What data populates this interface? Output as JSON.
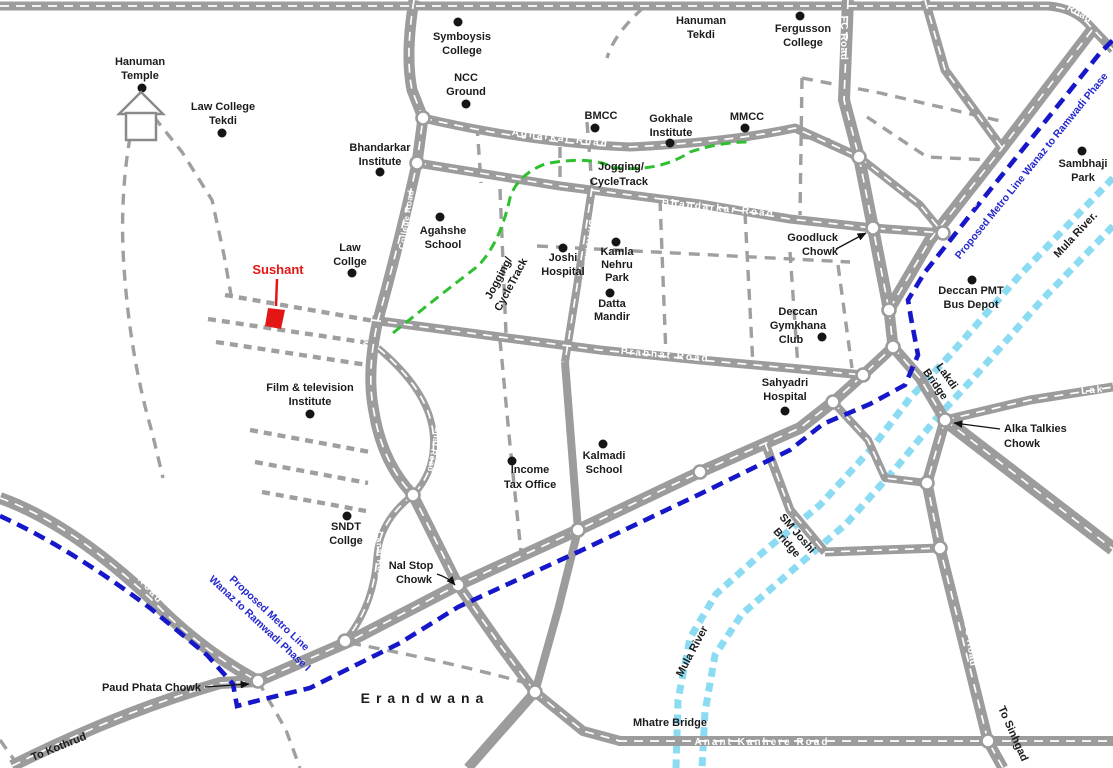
{
  "region": {
    "name": "Erandwana"
  },
  "colors": {
    "road_gray": "#9c9c9c",
    "metro_blue": "#1617c9",
    "river_cyan": "#8bdcf2",
    "track_green": "#2fc02f",
    "highlight_red": "#e31515"
  },
  "places": {
    "hanuman_temple": {
      "l1": "Hanuman",
      "l2": "Temple"
    },
    "law_college_tekdi": {
      "l1": "Law College",
      "l2": "Tekdi"
    },
    "symboysis_college": {
      "l1": "Symboysis",
      "l2": "College"
    },
    "ncc_ground": {
      "l1": "NCC",
      "l2": "Ground"
    },
    "hanuman_tekdi": {
      "l1": "Hanuman",
      "l2": "Tekdi"
    },
    "fergusson_college": {
      "l1": "Fergusson",
      "l2": "College"
    },
    "bmcc": {
      "l1": "BMCC"
    },
    "gokhale_institute": {
      "l1": "Gokhale",
      "l2": "Institute"
    },
    "mmcc": {
      "l1": "MMCC"
    },
    "bhandarkar_institute": {
      "l1": "Bhandarkar",
      "l2": "Institute"
    },
    "sambhaji_park": {
      "l1": "Sambhaji",
      "l2": "Park"
    },
    "agahshe_school": {
      "l1": "Agahshe",
      "l2": "School"
    },
    "law_collge": {
      "l1": "Law",
      "l2": "Collge"
    },
    "joshi_hospital": {
      "l1": "Joshi",
      "l2": "Hospital"
    },
    "kamla_nehru_park": {
      "l1": "Kamla",
      "l2": "Nehru",
      "l3": "Park"
    },
    "datta_mandir": {
      "l1": "Datta",
      "l2": "Mandir"
    },
    "deccan_gymkhana_club": {
      "l1": "Deccan",
      "l2": "Gymkhana",
      "l3": "Club"
    },
    "goodluck_chowk": {
      "l1": "Goodluck",
      "l2": "Chowk"
    },
    "deccan_pmt_bus_depot": {
      "l1": "Deccan PMT",
      "l2": "Bus Depot"
    },
    "sahyadri_hospital": {
      "l1": "Sahyadri",
      "l2": "Hospital"
    },
    "film_tv_institute": {
      "l1": "Film & television",
      "l2": "Institute"
    },
    "income_tax_office": {
      "l1": "Income",
      "l2": "Tax Office"
    },
    "kalmadi_school": {
      "l1": "Kalmadi",
      "l2": "School"
    },
    "sndt_collge": {
      "l1": "SNDT",
      "l2": "Collge"
    },
    "sushant": {
      "l1": "Sushant"
    },
    "alka_talkies_chowk": {
      "l1": "Alka Talkies",
      "l2": "Chowk"
    },
    "nal_stop_chowk": {
      "l1": "Nal Stop",
      "l2": "Chowk"
    },
    "paud_phata_chowk": {
      "l1": "Paud Phata Chowk"
    }
  },
  "roads": {
    "top_right": "Road",
    "college_road": "College Road",
    "law": "Law",
    "agharkar": "Agharkar Road",
    "bhandarkar": "Bhandarkar Road",
    "fc": "FC Road",
    "jangli_maharaj": "Jangli Maharaj Road",
    "prabhat": "Prabhat Road",
    "dr_ketkar": "Dr. Ketkar Road",
    "canal": "Canal Road",
    "income_tax_lane": "Income Tax Lane",
    "karve": "Karve Road",
    "paud": "Paud Road",
    "anant_kanhere": "Anant Kanhere Road",
    "lbs": "LBS Road",
    "lak": "Lak"
  },
  "bridges": {
    "lakdi": {
      "l1": "Lakdi",
      "l2": "Bridge"
    },
    "sm_joshi": {
      "l1": "SM Joshi",
      "l2": "Bridge"
    },
    "mhatre": "Mhatre Bridge"
  },
  "directions": {
    "to_kothrud": "To Kothrud",
    "to_sinhgad": "To Sinhgad"
  },
  "metro": {
    "label_line1": "Proposed Metro Line",
    "label_line2": "Wanaz to Ramwadi Phase I",
    "label_ne": "Proposed Metro Line Wanaz to Ramwadi Phase"
  },
  "river": {
    "label_ne": "Mula River.",
    "label_s": "Mula River"
  },
  "jogging_track": {
    "l1": "Jogging/",
    "l2": "CycleTrack"
  },
  "area": {
    "erandwana": "Erandwana"
  }
}
